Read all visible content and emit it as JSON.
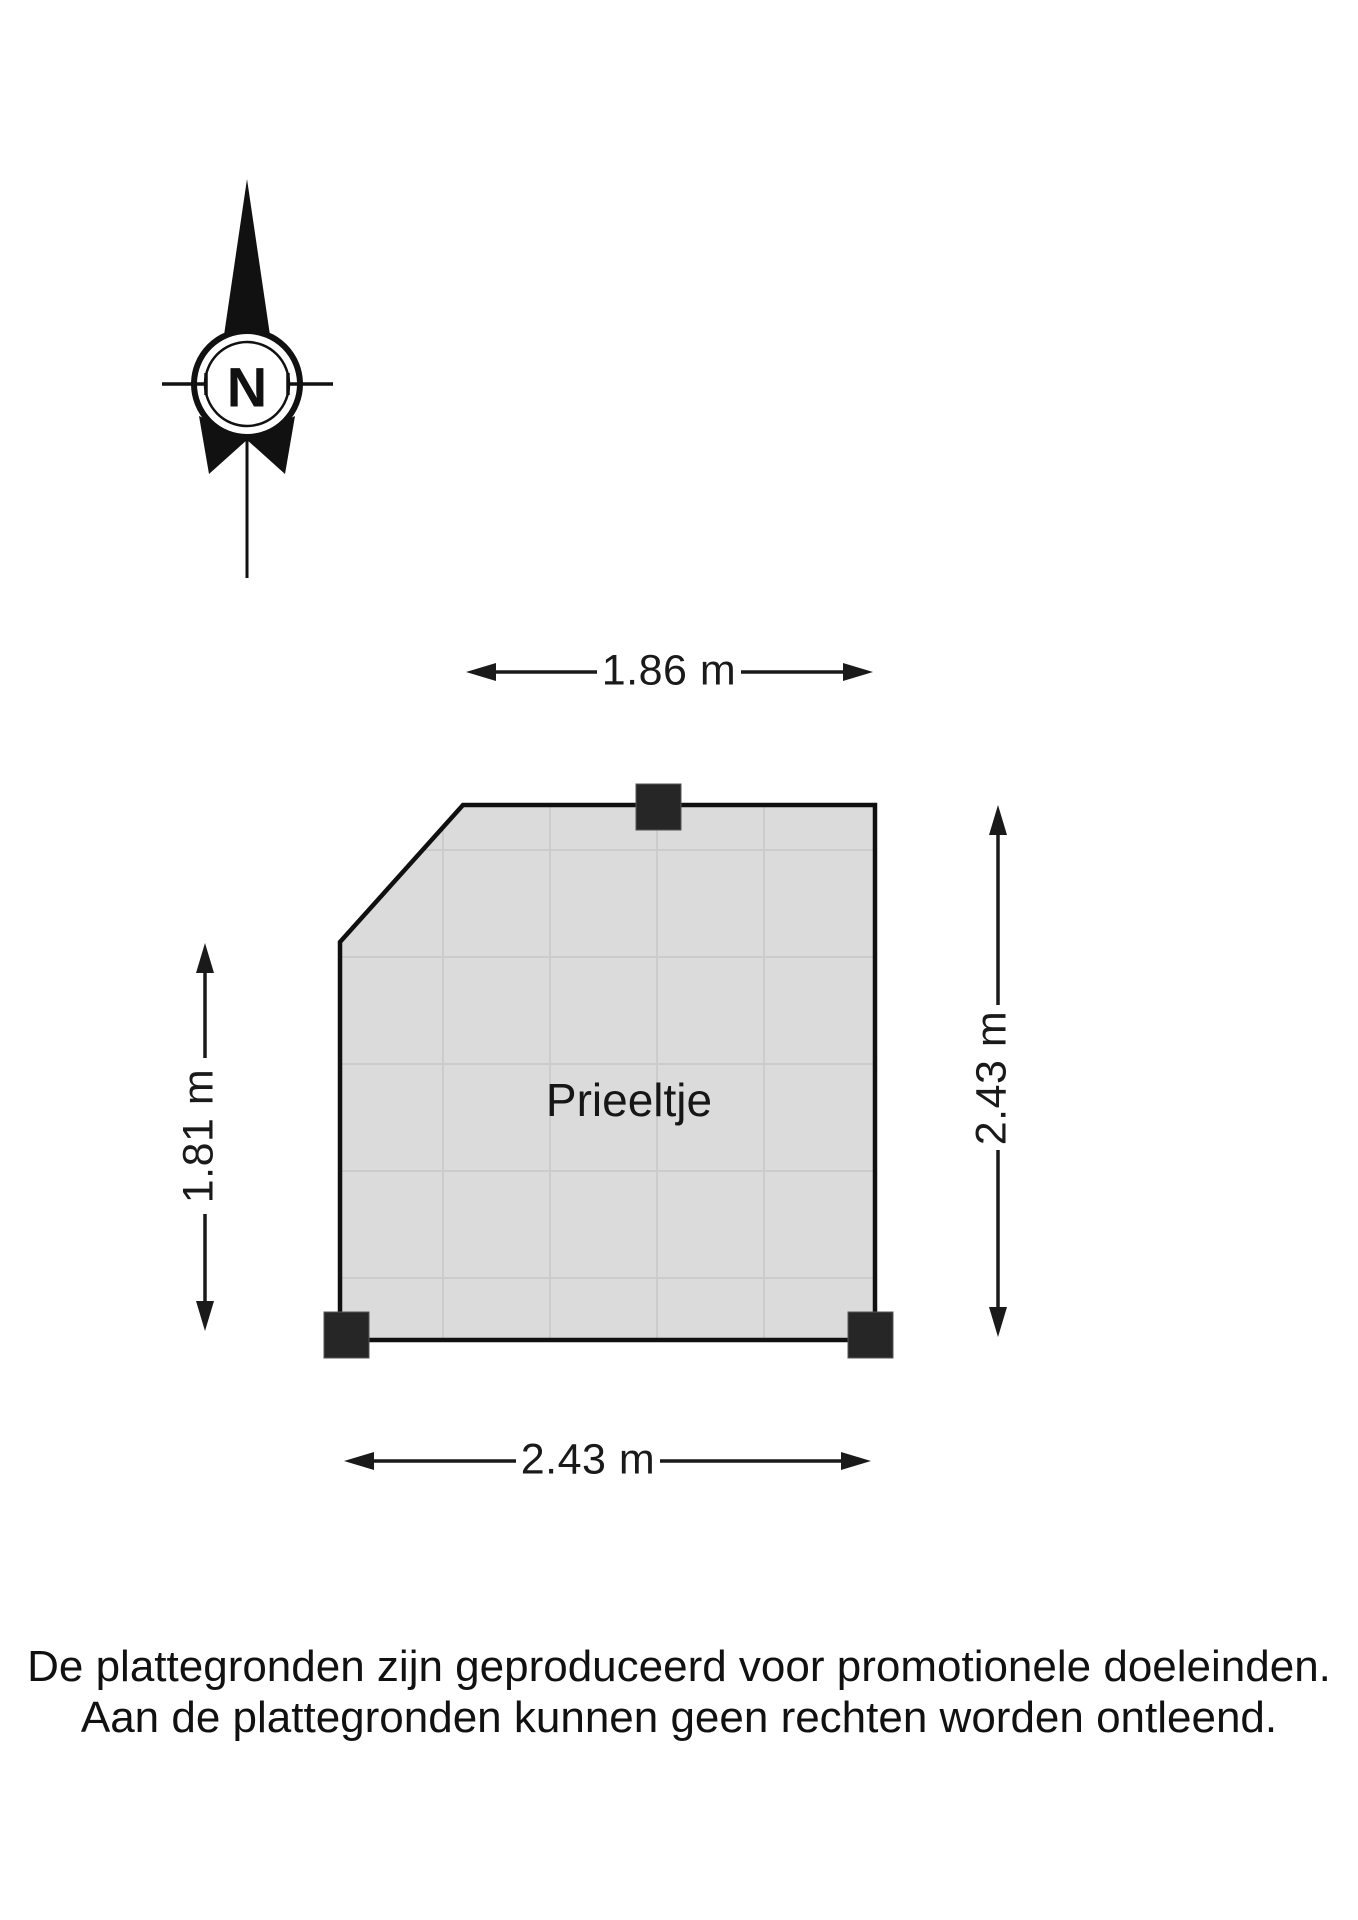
{
  "page": {
    "background_color": "#ffffff",
    "line_color": "#1a1a1a"
  },
  "compass": {
    "label": "N"
  },
  "floor_plan": {
    "room_label": "Prieeltje",
    "fill_color": "#dbdbdb",
    "grid_color": "#cccccc",
    "outline_color": "#101010",
    "post_color": "#262626"
  },
  "dimensions": {
    "top": "1.86 m",
    "left": "1.81 m",
    "right": "2.43 m",
    "bottom": "2.43 m"
  },
  "footer": {
    "line1": "De plattegronden zijn geproduceerd voor promotionele doeleinden.",
    "line2": "Aan de plattegronden kunnen geen rechten worden ontleend."
  }
}
